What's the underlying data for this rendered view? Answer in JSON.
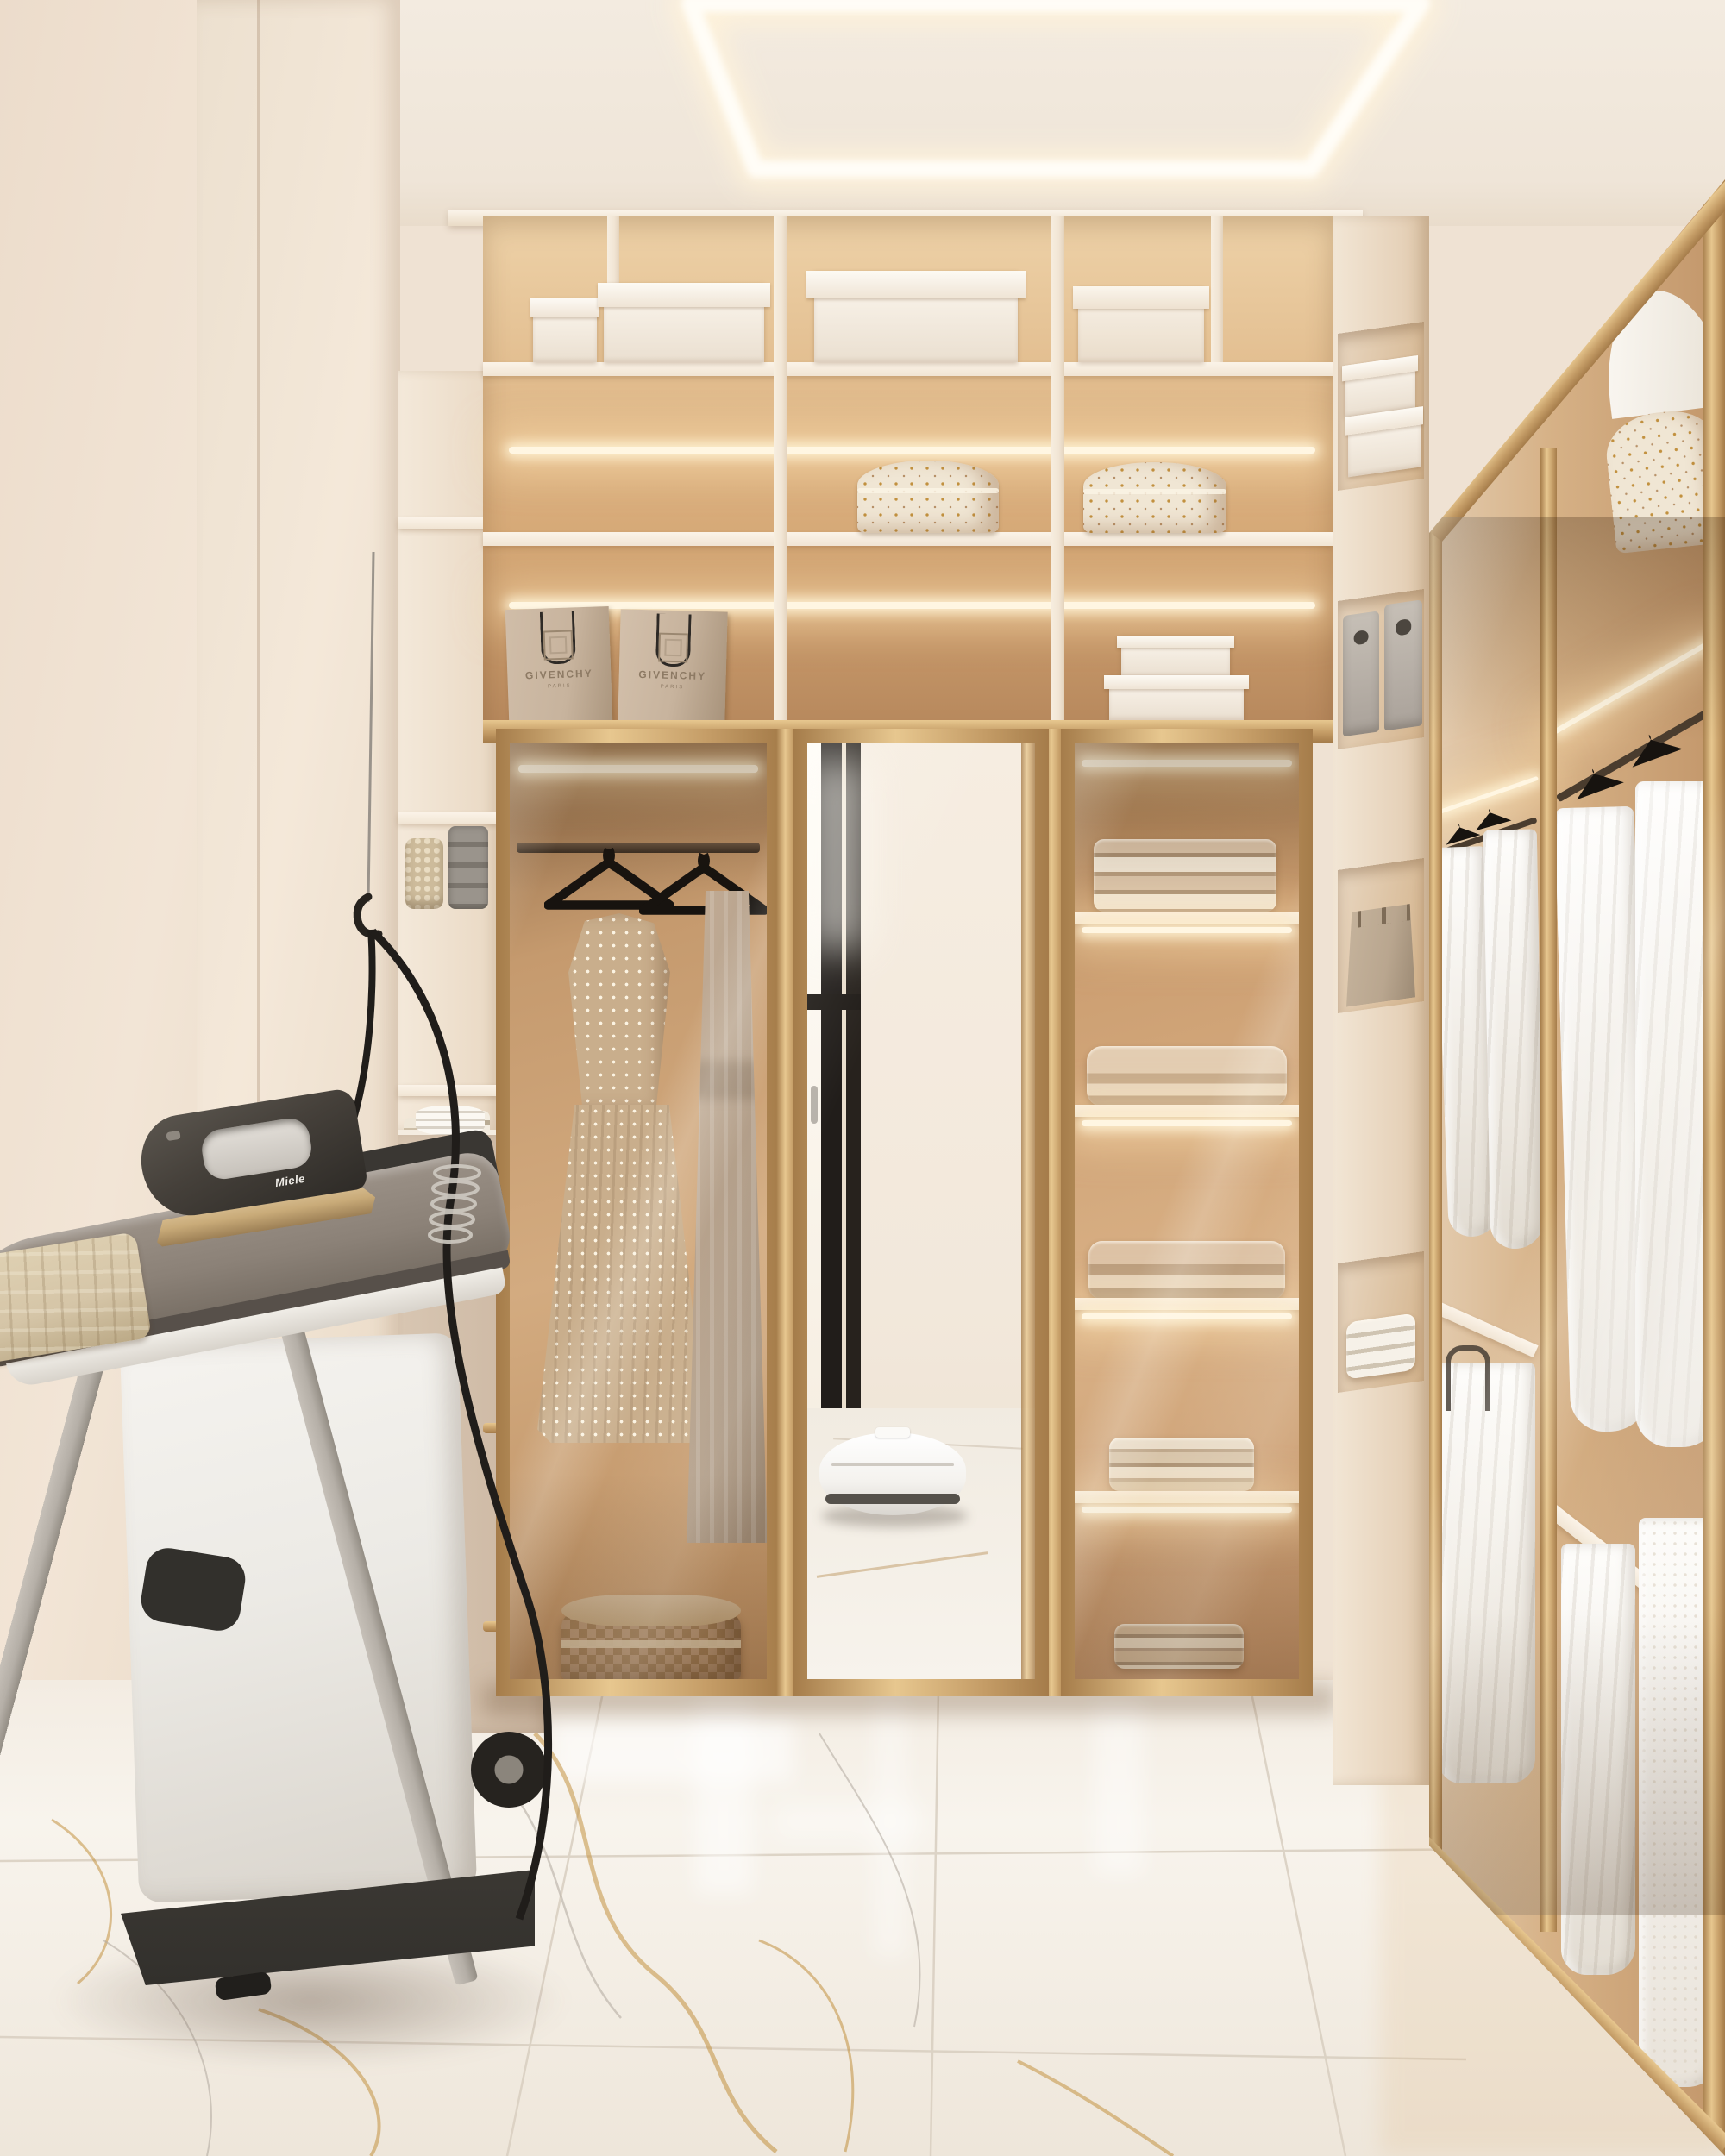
{
  "brands": {
    "bag1": {
      "name": "GIVENCHY",
      "city": "PARIS"
    },
    "bag2": {
      "name": "GIVENCHY",
      "city": "PARIS"
    },
    "iron": {
      "name": "Miele"
    }
  },
  "colors": {
    "wall": "#efe2d3",
    "wallShade": "#e4d2bf",
    "ceiling": "#f3ebe0",
    "soffit": "#f8f1e7",
    "led": "#fff6e2",
    "shelfFace": "#f1e5d4",
    "backHi": "#eed2a8",
    "back": "#d6a977",
    "backLo": "#b4855a",
    "goldHi": "#e7c78f",
    "gold": "#c49c66",
    "goldLo": "#a57c4a",
    "floorHi": "#f8f4ed",
    "floorLo": "#eee6da",
    "seam": "#d8cec0",
    "veinGold": "#c2913f",
    "veinGray": "#b5aea3",
    "ironDark": "#45403a",
    "ironGold": "#c9ab79",
    "boardTop": "#8b8177",
    "stationWhite": "#eceae5",
    "legGray": "#b5afa7",
    "baseBlack": "#32302c",
    "polka": "#c9ae8c",
    "taupe": "#b29e89",
    "hanger": "#1d1a16",
    "linenA": "#d9c2a7",
    "linenB": "#c9ae92",
    "linenC": "#efe4d2",
    "bagBeige": "#c7b39d",
    "mirrorFace": "#f2e8db",
    "doorBlack": "#211d1a",
    "vacuum": "#f4f2ee",
    "felt": "#aaa29a",
    "tote": "#b9a68f",
    "railDark": "#55453a",
    "clothBeige": "#d5c5a7"
  }
}
